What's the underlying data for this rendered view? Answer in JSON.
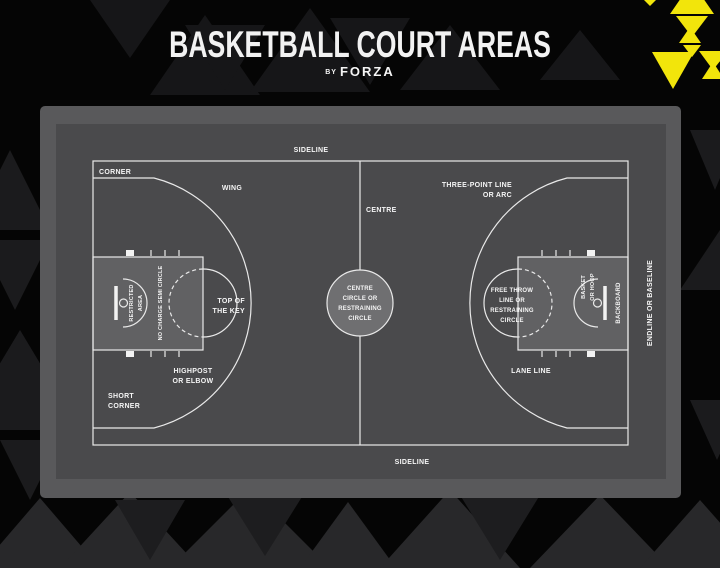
{
  "header": {
    "title": "BASKETBALL COURT AREAS",
    "by": "BY",
    "brand": "FORZA"
  },
  "colors": {
    "background": "#050505",
    "accent_yellow": "#f2e50b",
    "panel_outer": "#59595b",
    "court_background": "#4a4a4c",
    "key_fill": "#616163",
    "centre_circle_fill": "#6f6f71",
    "court_line": "#e9e9e9",
    "label_text": "#f5f5f5"
  },
  "court": {
    "labels": {
      "sideline_top": "SIDELINE",
      "sideline_bottom": "SIDELINE",
      "corner": "CORNER",
      "wing": "WING",
      "centre": "CENTRE",
      "three_point": [
        "THREE-POINT LINE",
        "OR ARC"
      ],
      "centre_circle": [
        "CENTRE",
        "CIRCLE OR",
        "RESTRAINING",
        "CIRCLE"
      ],
      "free_throw": [
        "FREE THROW",
        "LINE OR",
        "RESTRAINING",
        "CIRCLE"
      ],
      "top_of_key": [
        "TOP OF",
        "THE KEY"
      ],
      "highpost": [
        "HIGHPOST",
        "OR ELBOW"
      ],
      "short_corner": [
        "SHORT",
        "CORNER"
      ],
      "lane_line": "LANE LINE",
      "restricted_area": [
        "RESTRICTED",
        "AREA"
      ],
      "no_charge": "NO CHARGE SEMI CIRCLE",
      "basket": [
        "BASKET",
        "OR HOOP"
      ],
      "backboard": "BACKBOARD",
      "endline": "ENDLINE OR BASELINE"
    }
  }
}
